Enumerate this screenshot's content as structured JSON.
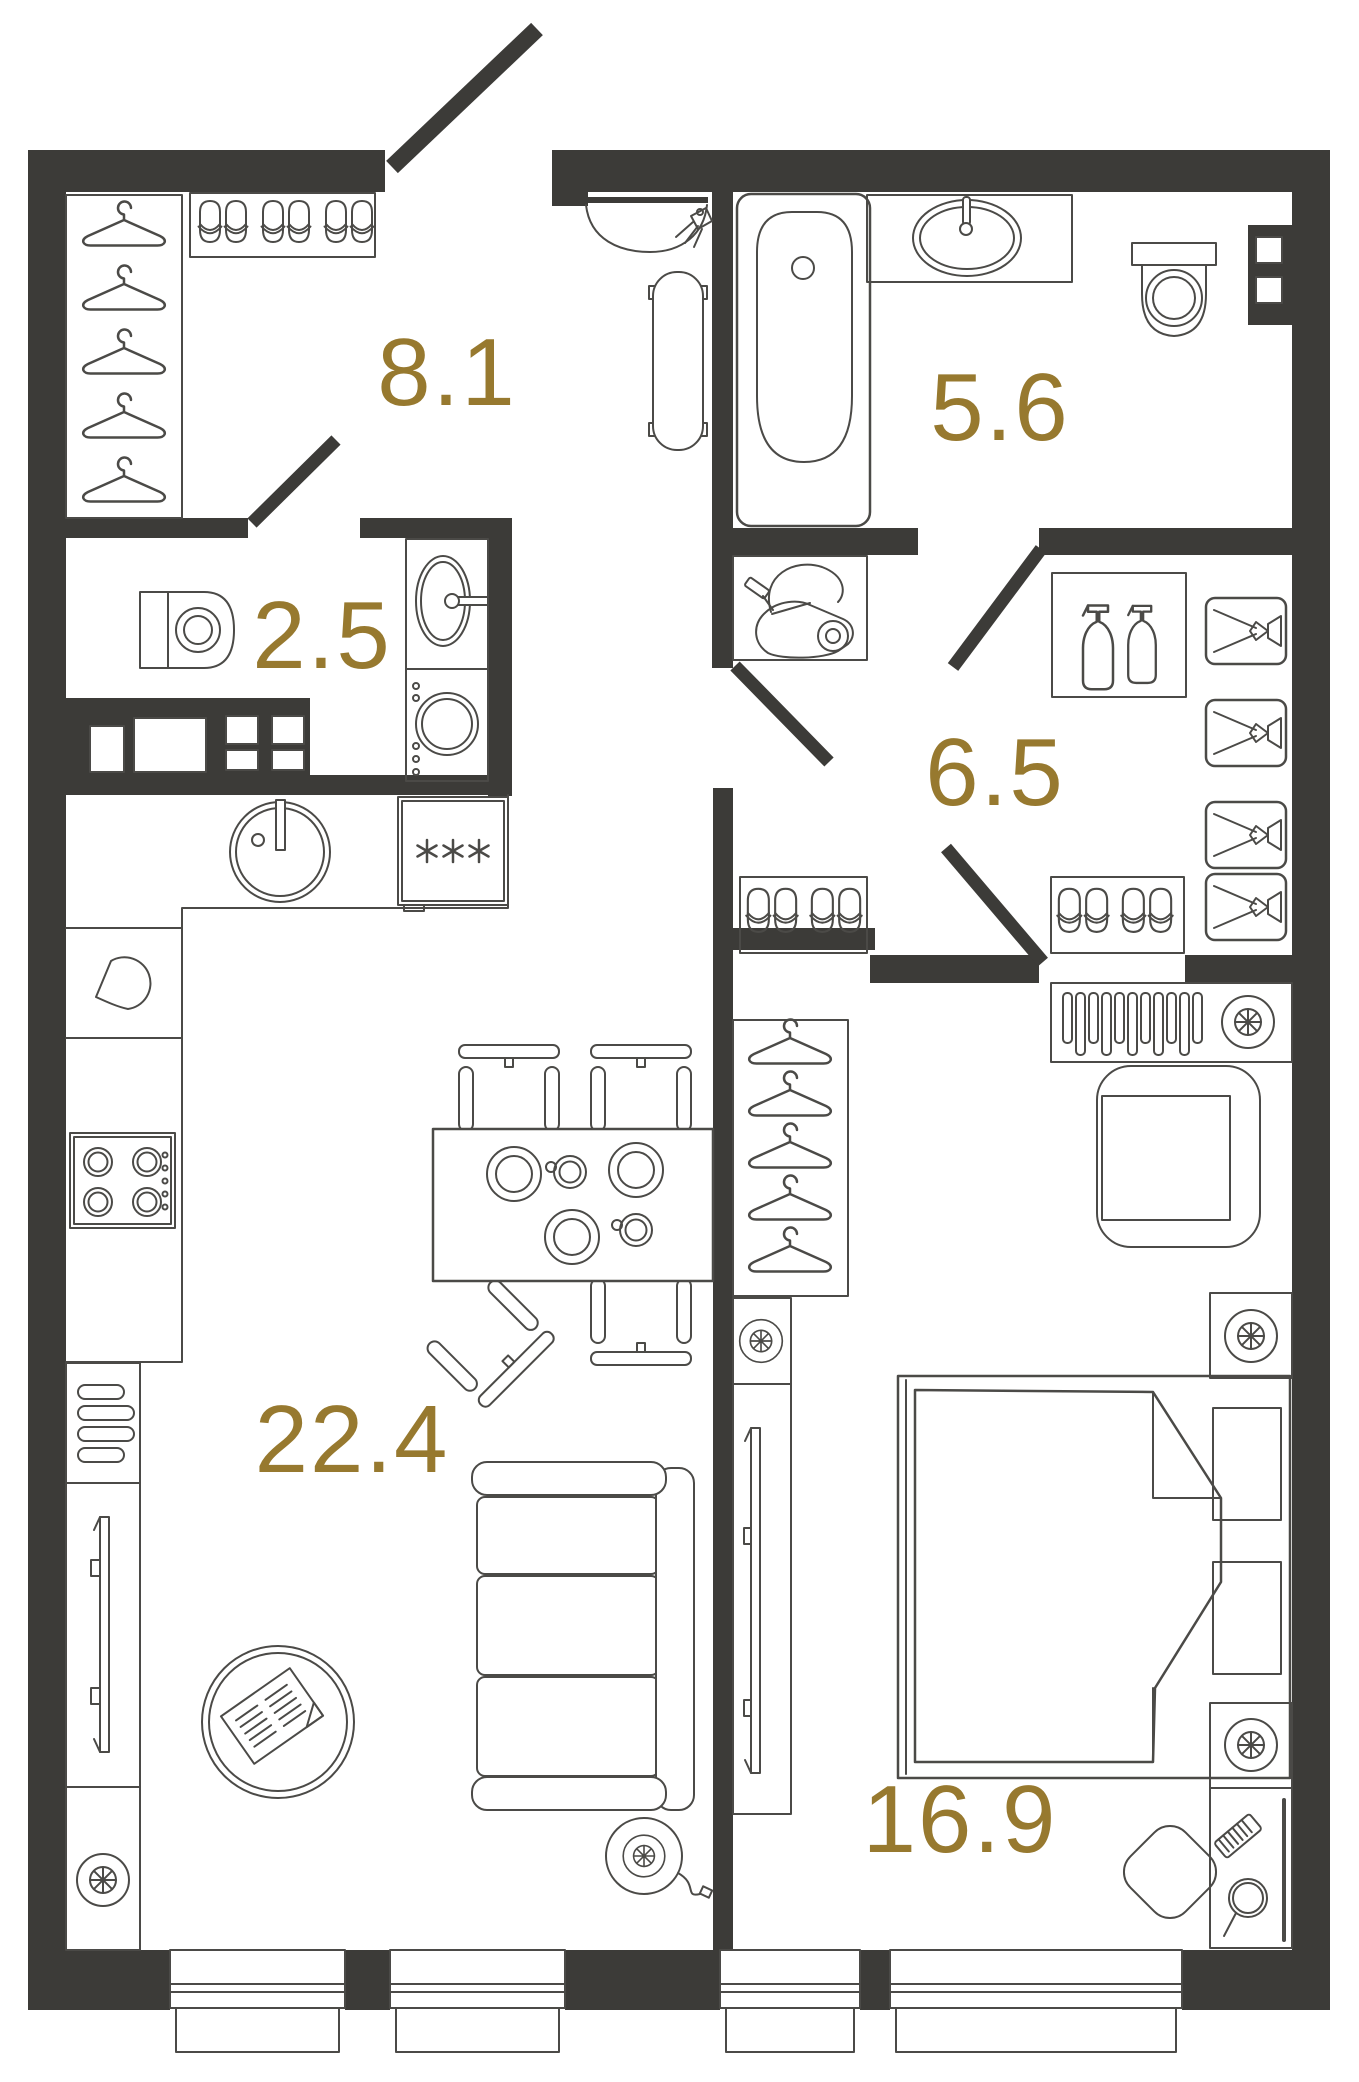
{
  "plan": {
    "type": "apartment-floor-plan",
    "rooms": [
      {
        "id": "hallway",
        "label": "8.1"
      },
      {
        "id": "wc",
        "label": "2.5"
      },
      {
        "id": "bathroom",
        "label": "5.6"
      },
      {
        "id": "wardrobe",
        "label": "6.5"
      },
      {
        "id": "living-kitchen",
        "label": "22.4"
      },
      {
        "id": "bedroom",
        "label": "16.9"
      }
    ],
    "colors": {
      "wall": "#3C3B38",
      "furniture_line": "#4B4A47",
      "room_label": "#97792F",
      "background": "#FFFFFF"
    },
    "icons": [
      "hanger-icon",
      "slippers-icon",
      "entry-door-icon",
      "interior-door-icon",
      "toilet-icon",
      "vanity-sink-icon",
      "washing-machine-icon",
      "corner-sink-icon",
      "towel-radiator-icon",
      "bathtub-icon",
      "counter-sink-icon",
      "ventilation-shaft-icon",
      "vacuum-cleaner-icon",
      "spray-bottles-icon",
      "storage-drawer-icon",
      "kitchen-sink-icon",
      "kettle-icon",
      "cooktop-icon",
      "freezer-icon",
      "dining-table-icon",
      "chair-icon",
      "plate-icon",
      "cup-icon",
      "sofa-icon",
      "coffee-table-icon",
      "magazine-icon",
      "tv-icon",
      "radiator-icon",
      "floor-fan-icon",
      "vent-fan-icon",
      "bed-icon",
      "nightstand-icon",
      "armchair-icon",
      "dressing-table-icon",
      "comb-icon",
      "hand-mirror-icon",
      "window-icon"
    ]
  }
}
